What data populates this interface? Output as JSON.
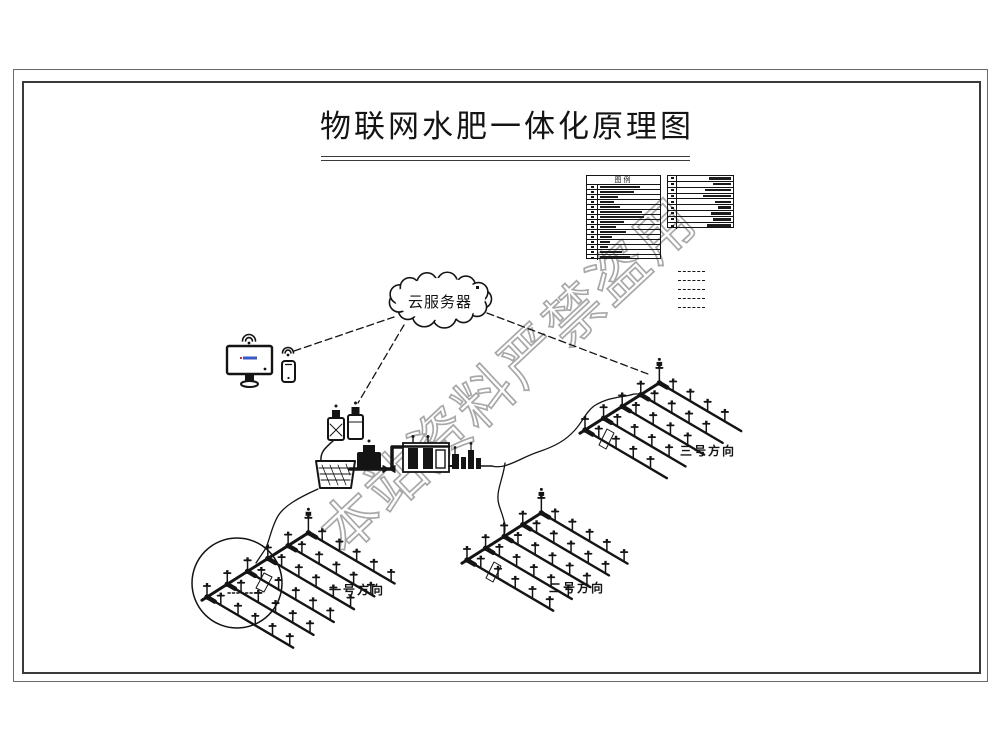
{
  "drawing": {
    "title": "物联网水肥一体化原理图",
    "watermark": "本站资料严禁盗用",
    "cloud_label": "云服务器",
    "legend": {
      "header": "图例",
      "left_table_rows": 15,
      "right_table_rows": 9,
      "linetype_samples": 5
    },
    "fields": [
      {
        "label": "一号方向"
      },
      {
        "label": "二号方向"
      },
      {
        "label": "三号方向"
      }
    ],
    "colors": {
      "ink": "#141414",
      "watermark": "#a8a8a8",
      "screen_accent": "#3a57c4"
    },
    "icons": [
      "cloud-icon",
      "wifi-icon",
      "monitor-icon",
      "smartphone-icon",
      "water-tank-icon",
      "pump-icon",
      "fertilizer-tank-icon",
      "filter-unit-icon",
      "sprinkler-icon",
      "antenna-dot-icon"
    ]
  }
}
